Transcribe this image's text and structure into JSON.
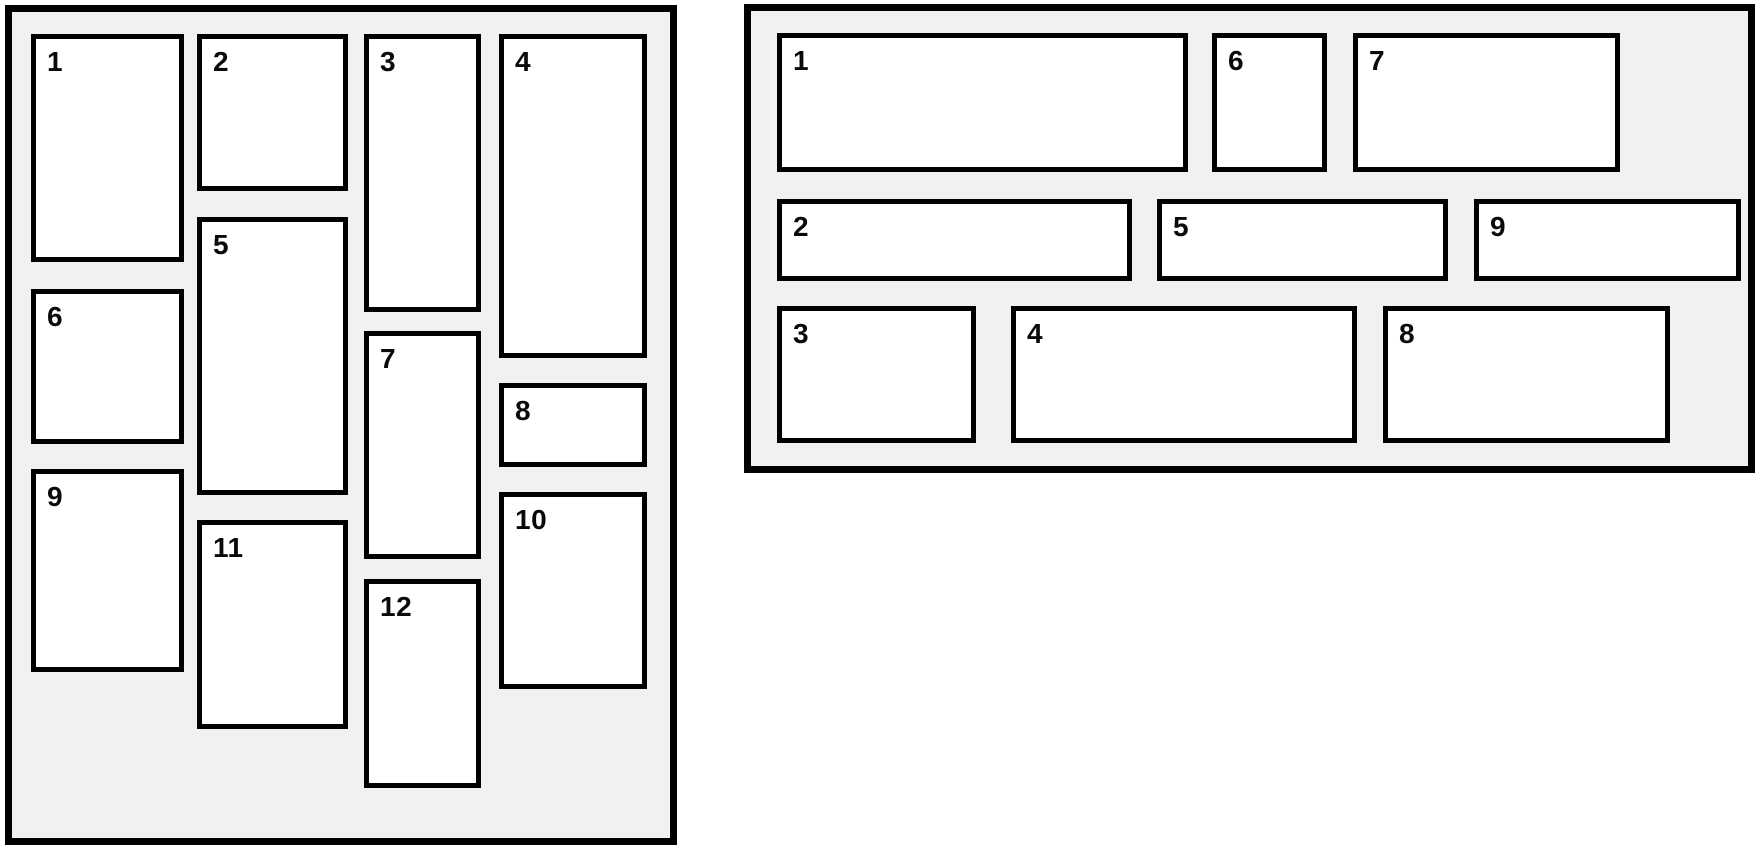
{
  "colors": {
    "page_background": "#ffffff",
    "panel_background": "#f1f1f1",
    "border": "#000000",
    "item_background": "#ffffff",
    "item_text": "#0a0a0a"
  },
  "diagram": {
    "description_left": "column-masonry layout with 12 numbered items in 4 columns",
    "description_right": "row-masonry layout with 9 numbered items in 3 rows",
    "panels": [
      {
        "id": "left",
        "x": 5,
        "y": 5,
        "w": 672,
        "h": 840,
        "items": [
          {
            "label": "1",
            "x": 19,
            "y": 22,
            "w": 153,
            "h": 228
          },
          {
            "label": "2",
            "x": 185,
            "y": 22,
            "w": 151,
            "h": 157
          },
          {
            "label": "3",
            "x": 352,
            "y": 22,
            "w": 117,
            "h": 278
          },
          {
            "label": "4",
            "x": 487,
            "y": 22,
            "w": 148,
            "h": 324
          },
          {
            "label": "5",
            "x": 185,
            "y": 205,
            "w": 151,
            "h": 278
          },
          {
            "label": "6",
            "x": 19,
            "y": 277,
            "w": 153,
            "h": 155
          },
          {
            "label": "7",
            "x": 352,
            "y": 319,
            "w": 117,
            "h": 228
          },
          {
            "label": "8",
            "x": 487,
            "y": 371,
            "w": 148,
            "h": 84
          },
          {
            "label": "9",
            "x": 19,
            "y": 457,
            "w": 153,
            "h": 203
          },
          {
            "label": "10",
            "x": 487,
            "y": 480,
            "w": 148,
            "h": 197
          },
          {
            "label": "11",
            "x": 185,
            "y": 508,
            "w": 151,
            "h": 209
          },
          {
            "label": "12",
            "x": 352,
            "y": 567,
            "w": 117,
            "h": 209
          }
        ]
      },
      {
        "id": "right",
        "x": 744,
        "y": 4,
        "w": 1011,
        "h": 469,
        "items": [
          {
            "label": "1",
            "x": 26,
            "y": 22,
            "w": 411,
            "h": 139
          },
          {
            "label": "2",
            "x": 26,
            "y": 188,
            "w": 355,
            "h": 82
          },
          {
            "label": "3",
            "x": 26,
            "y": 295,
            "w": 199,
            "h": 137
          },
          {
            "label": "4",
            "x": 260,
            "y": 295,
            "w": 346,
            "h": 137
          },
          {
            "label": "5",
            "x": 406,
            "y": 188,
            "w": 291,
            "h": 82
          },
          {
            "label": "6",
            "x": 461,
            "y": 22,
            "w": 115,
            "h": 139
          },
          {
            "label": "7",
            "x": 602,
            "y": 22,
            "w": 267,
            "h": 139
          },
          {
            "label": "8",
            "x": 632,
            "y": 295,
            "w": 287,
            "h": 137
          },
          {
            "label": "9",
            "x": 723,
            "y": 188,
            "w": 267,
            "h": 82
          }
        ]
      }
    ]
  }
}
